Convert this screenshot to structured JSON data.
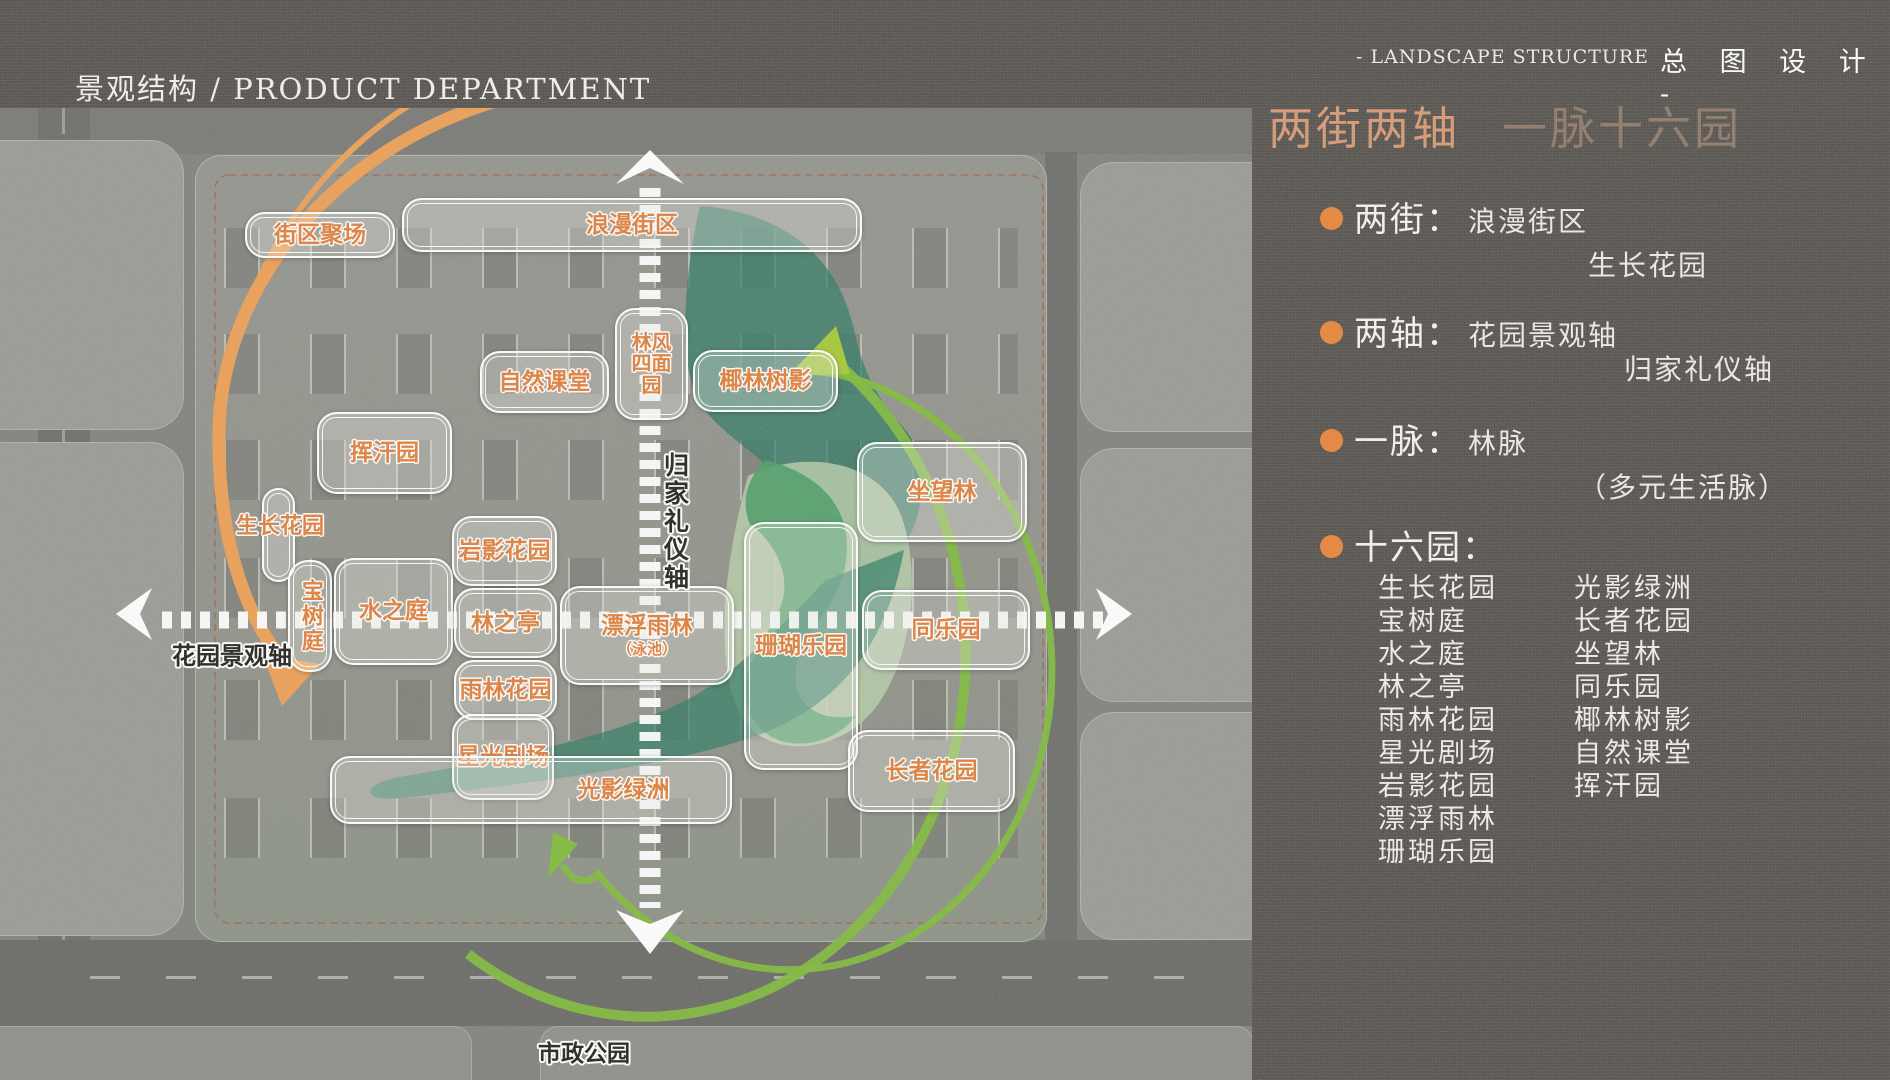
{
  "header": {
    "left_title": "景观结构 / PRODUCT DEPARTMENT",
    "right_subtitle": "- LANDSCAPE STRUCTURE",
    "right_title": "总 图 设 计 -"
  },
  "panel": {
    "heading_primary": "两街两轴",
    "heading_secondary": "一脉十六园",
    "bullets": [
      {
        "label": "两街：",
        "line1": "浪漫街区",
        "line2": "生长花园"
      },
      {
        "label": "两轴：",
        "line1": "花园景观轴",
        "line2": "归家礼仪轴"
      },
      {
        "label": "一脉：",
        "line1": "林脉",
        "line2": "（多元生活脉）"
      },
      {
        "label": "十六园：",
        "line1": "",
        "line2": ""
      }
    ],
    "gardens_col1": [
      "生长花园",
      "宝树庭",
      "水之庭",
      "林之亭",
      "雨林花园",
      "星光剧场",
      "岩影花园",
      "漂浮雨林",
      "珊瑚乐园"
    ],
    "gardens_col2": [
      "光影绿洲",
      "长者花园",
      "坐望林",
      "同乐园",
      "椰林树影",
      "自然课堂",
      "挥汗园"
    ]
  },
  "map": {
    "bottom_label": "市政公园",
    "colors": {
      "accent_orange": "#e8863c",
      "label_orange": "#e0813f",
      "arc_orange": "#eda057",
      "arc_green": "#82bb3e",
      "vein_teal": "#2e7c64",
      "sage_green": "#b7cda9",
      "axis_white": "#ffffff"
    },
    "labels": [
      {
        "name": "label-block-plaza",
        "text": "街区聚场",
        "x": 245,
        "y": 104,
        "w": 150,
        "h": 46
      },
      {
        "name": "label-romance-street",
        "text": "浪漫街区",
        "x": 402,
        "y": 90,
        "w": 460,
        "h": 54
      },
      {
        "name": "label-linfeng-simian-garden",
        "lines": [
          "林风",
          "四面",
          "园"
        ],
        "x": 615,
        "y": 200,
        "w": 73,
        "h": 112,
        "fs": 20
      },
      {
        "name": "label-nature-class",
        "text": "自然课堂",
        "x": 480,
        "y": 243,
        "w": 129,
        "h": 62
      },
      {
        "name": "label-coconut-grove",
        "text": "椰林树影",
        "x": 693,
        "y": 242,
        "w": 145,
        "h": 62
      },
      {
        "name": "label-sweat-garden",
        "text": "挥汗园",
        "x": 317,
        "y": 304,
        "w": 135,
        "h": 82
      },
      {
        "name": "label-sit-view-forest",
        "text": "坐望林",
        "x": 857,
        "y": 334,
        "w": 170,
        "h": 100
      },
      {
        "name": "pill-empty",
        "text": "",
        "x": 262,
        "y": 380,
        "w": 33,
        "h": 94
      },
      {
        "name": "label-growth-garden-map",
        "text": "生长花园",
        "x": 220,
        "y": 406,
        "w": 120,
        "h": 26,
        "cls": "ground",
        "fs": 22
      },
      {
        "name": "label-treasure-tree-court",
        "text": "宝树庭",
        "x": 288,
        "y": 452,
        "w": 44,
        "h": 112,
        "cls": "vert",
        "fs": 22
      },
      {
        "name": "label-water-court",
        "text": "水之庭",
        "x": 334,
        "y": 450,
        "w": 119,
        "h": 107
      },
      {
        "name": "label-rock-shadow-garden",
        "text": "岩影花园",
        "x": 452,
        "y": 408,
        "w": 105,
        "h": 70
      },
      {
        "name": "label-forest-pavilion",
        "text": "林之亭",
        "x": 454,
        "y": 480,
        "w": 103,
        "h": 70
      },
      {
        "name": "label-rainforest-garden",
        "text": "雨林花园",
        "x": 454,
        "y": 552,
        "w": 103,
        "h": 60
      },
      {
        "name": "label-floating-rainforest",
        "text": "漂浮雨林",
        "sub": "（泳池）",
        "x": 560,
        "y": 478,
        "w": 174,
        "h": 99
      },
      {
        "name": "label-coral-park",
        "text": "珊瑚乐园",
        "x": 744,
        "y": 414,
        "w": 114,
        "h": 248
      },
      {
        "name": "label-together-park",
        "text": "同乐园",
        "x": 862,
        "y": 482,
        "w": 168,
        "h": 80
      },
      {
        "name": "label-starlight-theater",
        "text": "星光剧场",
        "x": 452,
        "y": 606,
        "w": 102,
        "h": 86
      },
      {
        "name": "label-light-shadow-oasis",
        "text": "光影绿洲",
        "x": 330,
        "y": 648,
        "w": 402,
        "h": 68,
        "pad": 185
      },
      {
        "name": "label-elder-garden",
        "text": "长者花园",
        "x": 848,
        "y": 622,
        "w": 167,
        "h": 82
      },
      {
        "name": "label-homecoming-axis",
        "text": "归家礼仪轴",
        "x": 656,
        "y": 326,
        "w": 38,
        "h": 175,
        "cls": "ground dark vert",
        "fs": 25
      },
      {
        "name": "label-garden-landscape-axis",
        "text": "花园景观轴",
        "x": 156,
        "y": 532,
        "w": 152,
        "h": 32,
        "cls": "ground dark",
        "fs": 24
      },
      {
        "name": "label-municipal-park",
        "text": "市政公园",
        "x": 528,
        "y": 930,
        "w": 112,
        "h": 32,
        "cls": "ground dark",
        "fs": 23
      }
    ]
  }
}
